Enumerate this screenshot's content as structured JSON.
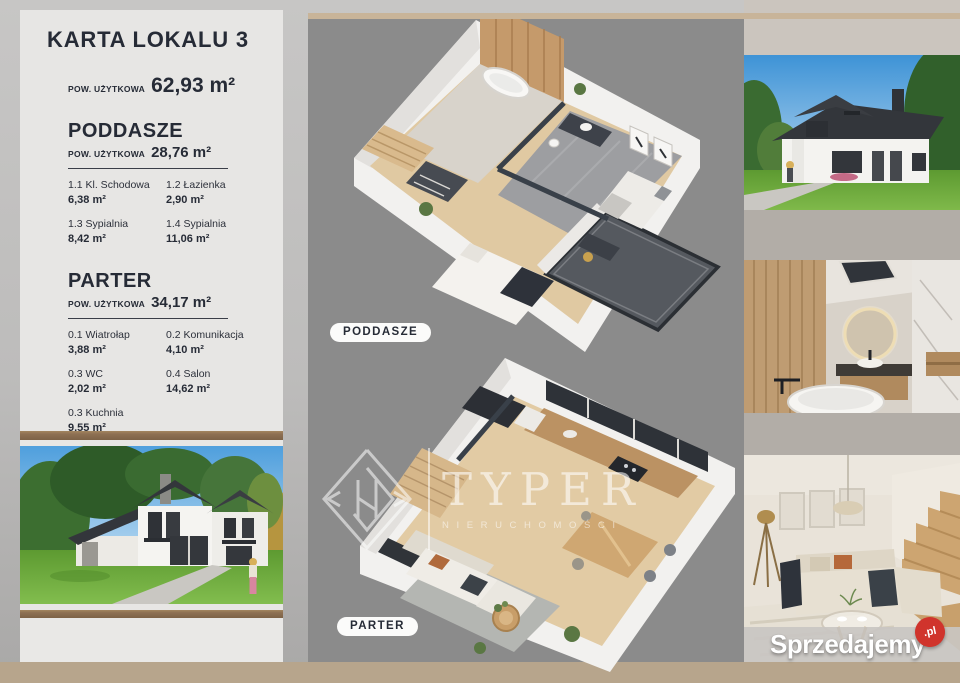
{
  "card": {
    "title": "KARTA LOKALU 3",
    "area_label": "POW. UŻYTKOWA",
    "total_area": "62,93 m²",
    "sections": [
      {
        "heading": "PODDASZE",
        "area_label": "POW. UŻYTKOWA",
        "area": "28,76 m²",
        "rooms": [
          {
            "name": "1.1 Kl. Schodowa",
            "area": "6,38 m²"
          },
          {
            "name": "1.2 Łazienka",
            "area": "2,90 m²"
          },
          {
            "name": "1.3 Sypialnia",
            "area": "8,42 m²"
          },
          {
            "name": "1.4 Sypialnia",
            "area": "11,06 m²"
          }
        ]
      },
      {
        "heading": "PARTER",
        "area_label": "POW. UŻYTKOWA",
        "area": "34,17 m²",
        "rooms": [
          {
            "name": "0.1 Wiatrołap",
            "area": "3,88 m²"
          },
          {
            "name": "0.2 Komunikacja",
            "area": "4,10 m²"
          },
          {
            "name": "0.3 WC",
            "area": "2,02 m²"
          },
          {
            "name": "0.4 Salon",
            "area": "14,62 m²"
          },
          {
            "name": "0.3 Kuchnia",
            "area": "9,55 m²"
          }
        ]
      }
    ]
  },
  "floor_labels": {
    "poddasze": "PODDASZE",
    "parter": "PARTER"
  },
  "watermark": {
    "brand": "TYPER",
    "subtitle": "NIERUCHOMOŚCI"
  },
  "footer_logo": {
    "name": "Sprzedajemy",
    "tld": ".pl"
  },
  "colors": {
    "page_bg_light": "#c7c6c5",
    "page_bg_mid": "#bdbcbb",
    "page_bg_dark": "#a9a8a7",
    "card_bg": "#e7e6e4",
    "panel_gray": "#8b8b8b",
    "right_col_bg": "#b2ada7",
    "right_col_top": "#cbc5be",
    "stripe_brown": "#8d7053",
    "footer_tan": "#b7a58c",
    "top_line_tan": "#c8b499",
    "text_navy": "#262b36",
    "pill_bg": "#fbfbfa",
    "logo_red": "#d0342c"
  }
}
